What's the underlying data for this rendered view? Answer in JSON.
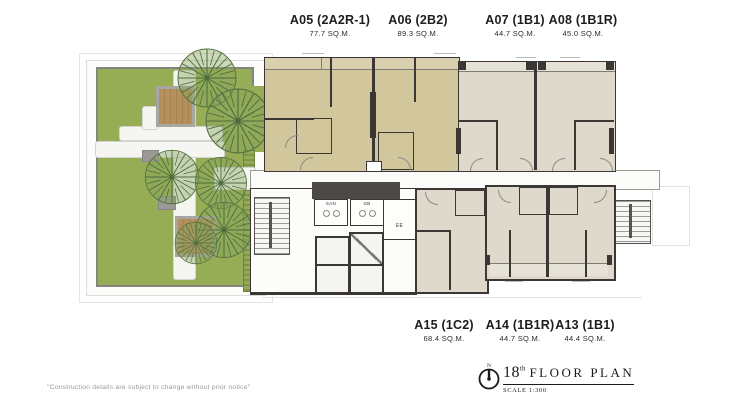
{
  "header_units": [
    {
      "name": "A05 (2A2R-1)",
      "area": "77.7 SQ.M."
    },
    {
      "name": "A06 (2B2)",
      "area": "89.3 SQ.M."
    },
    {
      "name": "A07 (1B1)",
      "area": "44.7 SQ.M."
    },
    {
      "name": "A08 (1B1R)",
      "area": "45.0 SQ.M."
    }
  ],
  "footer_units": [
    {
      "name": "A15 (1C2)",
      "area": "68.4 SQ.M."
    },
    {
      "name": "A14 (1B1R)",
      "area": "44.7 SQ.M."
    },
    {
      "name": "A13 (1B1)",
      "area": "44.4 SQ.M."
    }
  ],
  "plan_rooms": {
    "san": "SAN",
    "gb": "GB",
    "ee": "EE"
  },
  "title_block": {
    "north_letter": "N",
    "floor_number": "18",
    "ordinal_suffix": "th",
    "title": "FLOOR PLAN",
    "scale": "SCALE 1:300"
  },
  "disclaimer": "\"Construction details are subject to change without prior notice\"",
  "colors": {
    "unit_tan": "#d2c69d",
    "unit_beige": "#ded9cb",
    "wall": "#3a3734",
    "lawn_green": "#96ad55",
    "tree_green": "#5a7a44",
    "deck_brown": "#b3905c",
    "text": "#1d1d1d"
  }
}
